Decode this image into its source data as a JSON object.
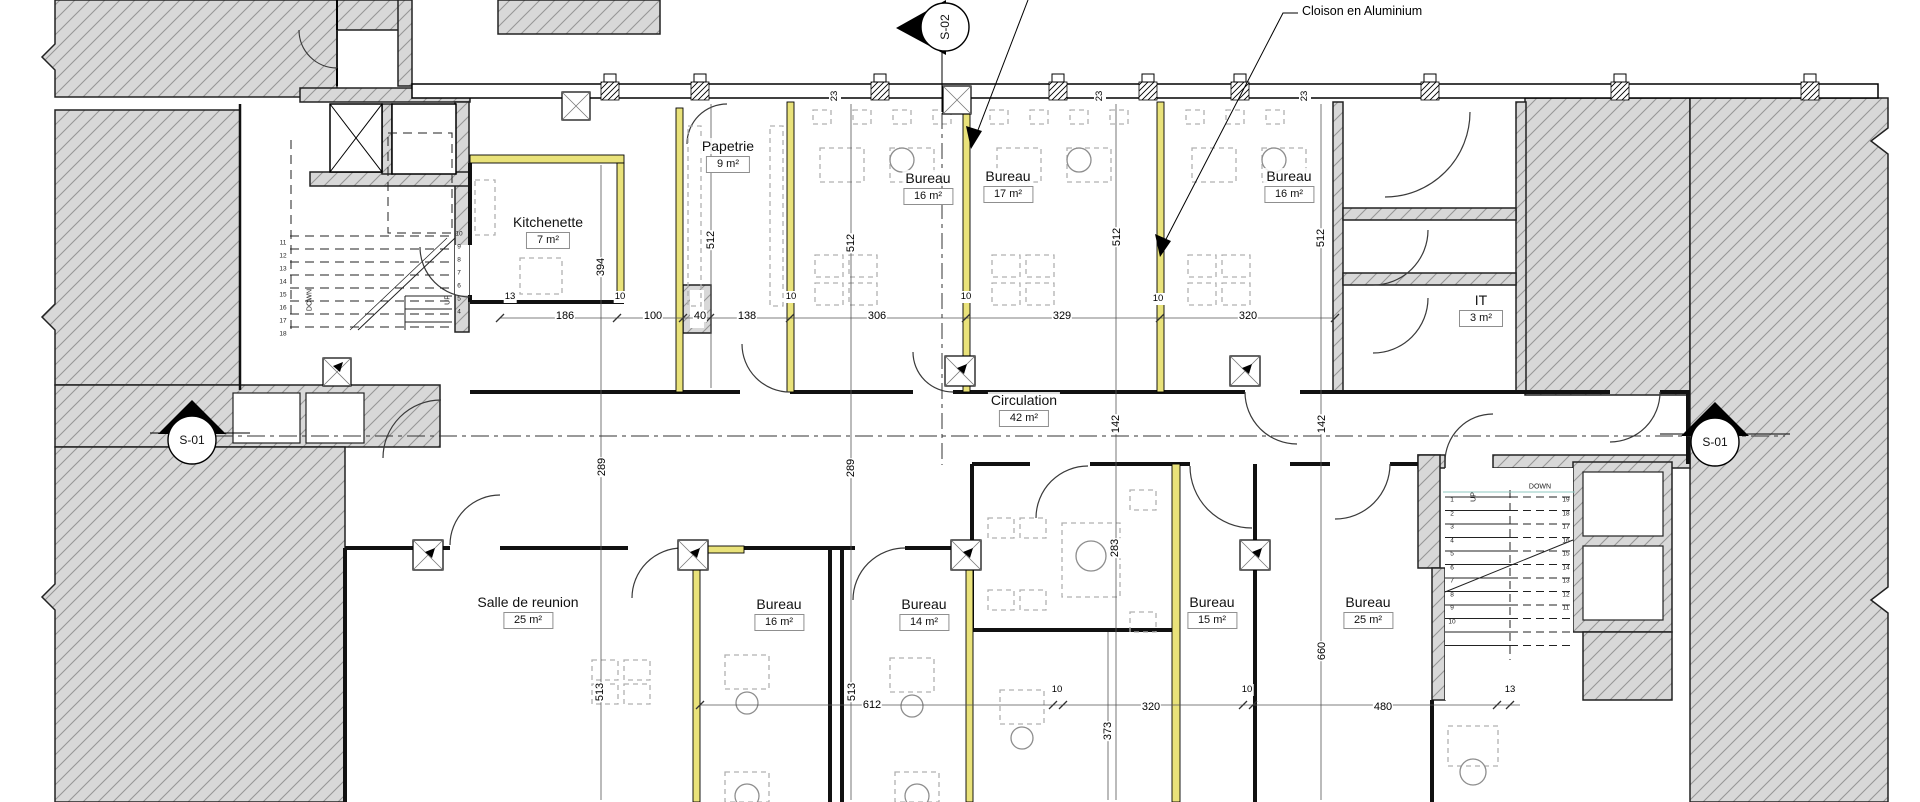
{
  "annotation": {
    "cloison": "Cloison en Aluminium"
  },
  "section_markers": {
    "s01": "S-01",
    "s02": "S-02"
  },
  "rooms": {
    "papetrie": {
      "name": "Papetrie",
      "area": "9 m²"
    },
    "kitchenette": {
      "name": "Kitchenette",
      "area": "7 m²"
    },
    "bureau_top_1": {
      "name": "Bureau",
      "area": "16 m²"
    },
    "bureau_top_2": {
      "name": "Bureau",
      "area": "17 m²"
    },
    "bureau_top_3": {
      "name": "Bureau",
      "area": "16 m²"
    },
    "it": {
      "name": "IT",
      "area": "3 m²"
    },
    "circulation": {
      "name": "Circulation",
      "area": "42 m²"
    },
    "salle_de_reunion": {
      "name": "Salle de reunion",
      "area": "25 m²"
    },
    "bureau_bottom_1": {
      "name": "Bureau",
      "area": "16 m²"
    },
    "bureau_bottom_2": {
      "name": "Bureau",
      "area": "14 m²"
    },
    "bureau_bottom_3": {
      "name": "Bureau",
      "area": "15 m²"
    },
    "bureau_bottom_4": {
      "name": "Bureau",
      "area": "25 m²"
    }
  },
  "dimensions": {
    "top_row": [
      "13",
      "186",
      "100",
      "40",
      "138",
      "306",
      "329",
      "320"
    ],
    "bottom_row": [
      "612",
      "320",
      "480",
      "13"
    ],
    "verticals": {
      "v394": "394",
      "v512": "512",
      "v289": "289",
      "v142": "142",
      "v283": "283",
      "v513": "513",
      "v373": "373",
      "v660": "660"
    },
    "wall_thickness": "10",
    "column_thickness": "23"
  },
  "stairs": {
    "left": {
      "up": "UP",
      "down": "DOWN",
      "col_left": [
        "11",
        "12",
        "13",
        "14",
        "15",
        "16",
        "17",
        "18"
      ],
      "col_right": [
        "10",
        "9",
        "8",
        "7",
        "6",
        "5",
        "4"
      ]
    },
    "right": {
      "up": "UP",
      "down": "DOWN",
      "col_left": [
        "1",
        "2",
        "3",
        "4",
        "5",
        "6",
        "7",
        "8",
        "9",
        "10"
      ],
      "col_right": [
        "19",
        "18",
        "17",
        "16",
        "15",
        "14",
        "13",
        "12",
        "11"
      ]
    }
  },
  "colors": {
    "partition_highlight": "#e9e27a",
    "hatch_fill": "#d8d8d8",
    "hatch_line": "#979797",
    "wall": "#111111"
  }
}
